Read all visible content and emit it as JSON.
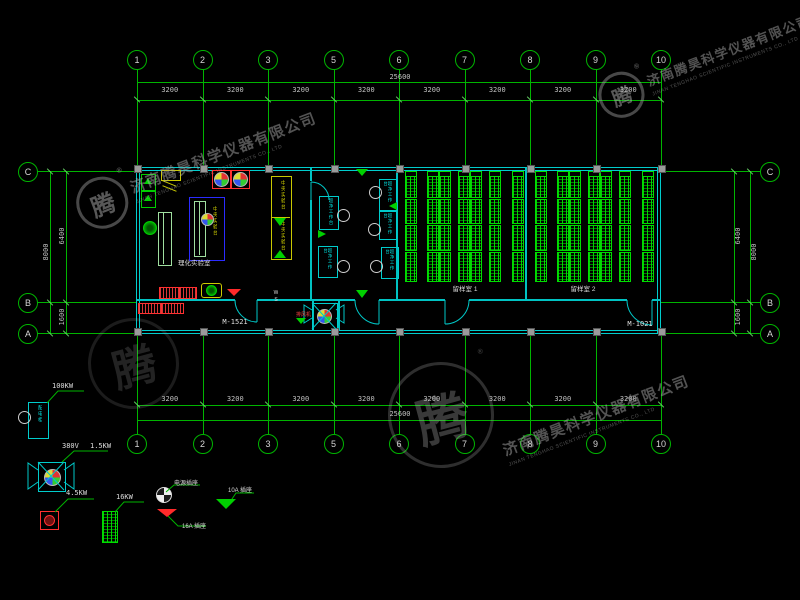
{
  "watermark": {
    "company_cn": "济南腾昊科学仪器有限公司",
    "company_en": "JINAN TENGHAO SCIENTIFIC INSTRUMENTS CO., LTD",
    "logo_char": "腾",
    "registered": "®"
  },
  "grid": {
    "columns": [
      "1",
      "2",
      "3",
      "5",
      "6",
      "7",
      "8",
      "9",
      "10"
    ],
    "rows": [
      "C",
      "B",
      "A"
    ],
    "bay_dims": [
      "3200",
      "3200",
      "3200",
      "3200",
      "3200",
      "3200",
      "3200",
      "3200"
    ],
    "total_width": "25600",
    "height_c_b": "6400",
    "height_b_a": "1600",
    "height_total": "8000"
  },
  "plan": {
    "door_left": "M-1521",
    "door_right": "M-1021",
    "lab_room": "理化实验室",
    "central_bench": "中央实验台",
    "clean_bench": "超净工作台",
    "sample_room_1": "留样室 1",
    "sample_room_2": "留样室 2",
    "ws": "WS",
    "exhaust_fan": "排风机"
  },
  "legend": {
    "main_power": "100KW",
    "cabinet": "配电柜",
    "fan_voltage": "380V",
    "fan_power": "1.5KW",
    "pump_power": "4.5KW",
    "rack_power": "16KW",
    "socket": "电源插座",
    "socket_16a": "16A 插座",
    "socket_10a": "10A 插座"
  },
  "colors": {
    "grid_green": "#00b400",
    "wall_cyan": "#00cccc",
    "rack_green": "#00dd00",
    "bench_blue": "#2b2bff",
    "bench_yellow": "#c8c800",
    "alert_red": "#ff3030",
    "dim_text": "#c0c0c0"
  }
}
